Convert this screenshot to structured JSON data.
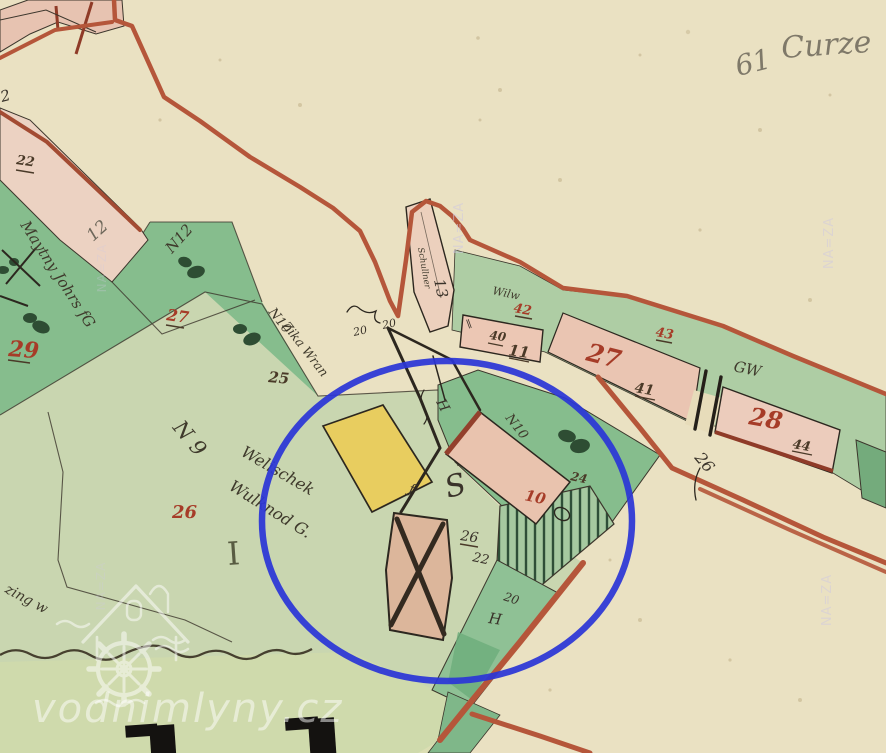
{
  "meta": {
    "type": "historical-cadastral-map-screenshot"
  },
  "colors": {
    "paper": "#eae1c2",
    "field_pale_green": "#c9d6b0",
    "field_medium_green": "#86bd8d",
    "strip_green": "#aecda4",
    "tree_green": "#2e4d33",
    "building_pink": "#e9c3ae",
    "road_pink": "#ecd2c2",
    "building_yellow": "#e8cd5f",
    "building_wood_tan": "#dcb69b",
    "boundary_red": "#b5563a",
    "building_edge_dark_red": "#8f3b28",
    "parcel_number_red": "#a63c28",
    "ink_dark": "#3a332a",
    "pencil_gray": "#6d675a",
    "annotation_blue": "#2b36d6",
    "watermark_white": "#ffffff"
  },
  "labels": {
    "corner_mark": "2",
    "parcel_22": "22",
    "pencil_12": "12",
    "owner_maytny": "Maytny Johrs fG",
    "field_n12": "N12",
    "parcel_27": "27",
    "parcel_29": "29",
    "field_n10": "N10",
    "owner_zika": "Zika Wran",
    "parcel_25": "25",
    "field_n9": "N 9",
    "owner_welischek": "Welischek",
    "owner_wulknod": "Wulknod G.",
    "parcel_26": "26",
    "meadow_mark": "I",
    "edge_script": "zing w",
    "house_13": "13",
    "owner_schullner": "Schullner",
    "num_20_a": "20",
    "num_20_b": "20",
    "parcel_42": "42",
    "script_wilw": "Wilw",
    "num_40": "40",
    "house_11": "11",
    "house_27": "27",
    "num_41": "41",
    "parcel_43": "43",
    "script_gw": "GW",
    "house_28": "28",
    "num_44": "44",
    "num_26_road": "26",
    "house_10": "10",
    "flourish_s": "S",
    "num_26_mill": "26",
    "num_22_mill": "22",
    "num_20_mill": "20",
    "letter_h_mill": "H",
    "letter_h_meadow": "H",
    "field_n10_wedge": "N10",
    "num_24": "24",
    "mark_f": "ƒ",
    "mark_parallel": "∥",
    "pencil_note_1": "61",
    "pencil_note_2": "Curze"
  },
  "watermarks": {
    "site": "vodnimlyny.cz",
    "archive": "NA=ZA"
  }
}
